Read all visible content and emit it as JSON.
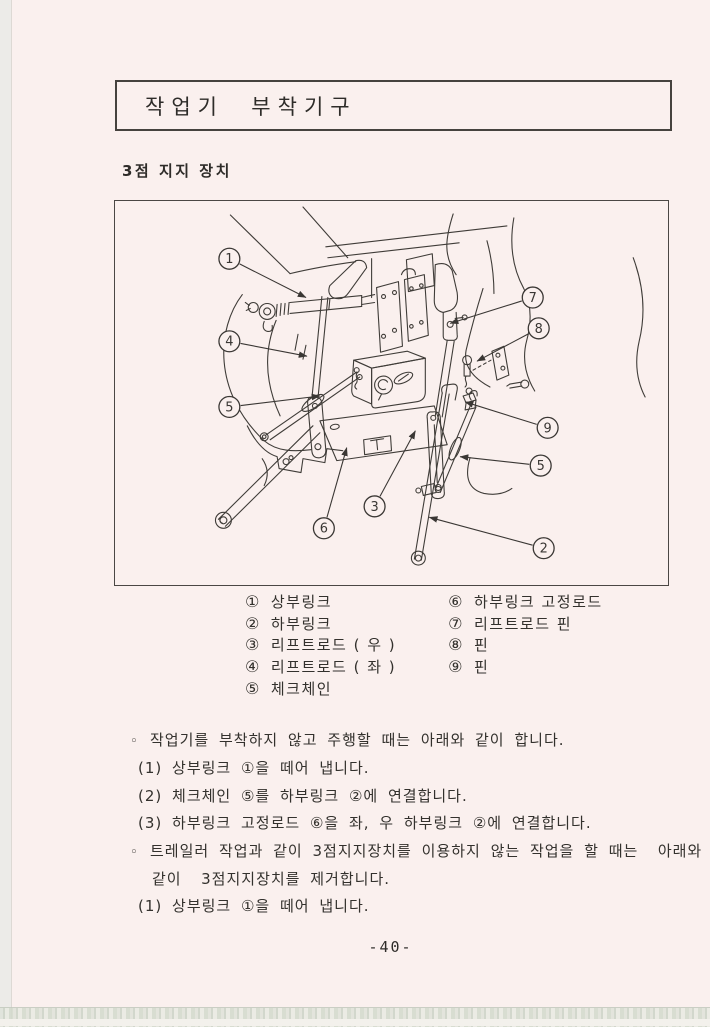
{
  "page": {
    "title": "작업기  부착기구",
    "section_heading": "3점 지지 장치",
    "page_number": "-40-"
  },
  "colors": {
    "paper": "#faf0ee",
    "ink": "#3a3734"
  },
  "figure": {
    "description": "3-point hitch linkage diagram (tractor rear)",
    "callouts": [
      {
        "num": "1",
        "x": 115,
        "y": 58,
        "tx": 192,
        "ty": 97
      },
      {
        "num": "4",
        "x": 115,
        "y": 141,
        "tx": 193,
        "ty": 156
      },
      {
        "num": "5",
        "x": 115,
        "y": 207,
        "tx": 206,
        "ty": 196
      },
      {
        "num": "7",
        "x": 420,
        "y": 97,
        "tx": 337,
        "ty": 123
      },
      {
        "num": "8",
        "x": 426,
        "y": 128,
        "tx": 364,
        "ty": 161
      },
      {
        "num": "9",
        "x": 435,
        "y": 228,
        "tx": 352,
        "ty": 202
      },
      {
        "num": "5",
        "x": 428,
        "y": 266,
        "tx": 347,
        "ty": 257
      },
      {
        "num": "3",
        "x": 261,
        "y": 307,
        "tx": 302,
        "ty": 231
      },
      {
        "num": "6",
        "x": 210,
        "y": 329,
        "tx": 233,
        "ty": 248
      },
      {
        "num": "2",
        "x": 431,
        "y": 349,
        "tx": 316,
        "ty": 318
      }
    ]
  },
  "legend": {
    "left": [
      {
        "num": "①",
        "label": "상부링크"
      },
      {
        "num": "②",
        "label": "하부링크"
      },
      {
        "num": "③",
        "label": "리프트로드 ( 우 )"
      },
      {
        "num": "④",
        "label": "리프트로드 ( 좌 )"
      },
      {
        "num": "⑤",
        "label": "체크체인"
      }
    ],
    "right": [
      {
        "num": "⑥",
        "label": "하부링크 고정로드"
      },
      {
        "num": "⑦",
        "label": "리프트로드 핀"
      },
      {
        "num": "⑧",
        "label": "핀"
      },
      {
        "num": "⑨",
        "label": "핀"
      }
    ]
  },
  "body": {
    "lines": [
      {
        "indent": 0,
        "bullet": "◦",
        "text": "작업기를 부착하지 않고 주행할 때는 아래와 같이 합니다."
      },
      {
        "indent": 1,
        "bullet": "",
        "text": "(1) 상부링크 ①을 떼어 냅니다."
      },
      {
        "indent": 1,
        "bullet": "",
        "text": "(2) 체크체인 ⑤를 하부링크 ②에 연결합니다."
      },
      {
        "indent": 1,
        "bullet": "",
        "text": "(3) 하부링크 고정로드 ⑥을 좌, 우 하부링크 ②에 연결합니다."
      },
      {
        "indent": 0,
        "bullet": "◦",
        "text": "트레일러 작업과 같이 3점지지장치를 이용하지 않는 작업을 할 때는  아래와"
      },
      {
        "indent": 2,
        "bullet": "",
        "text": "같이  3점지지장치를 제거합니다."
      },
      {
        "indent": 1,
        "bullet": "",
        "text": "(1) 상부링크 ①을 떼어 냅니다."
      }
    ]
  }
}
